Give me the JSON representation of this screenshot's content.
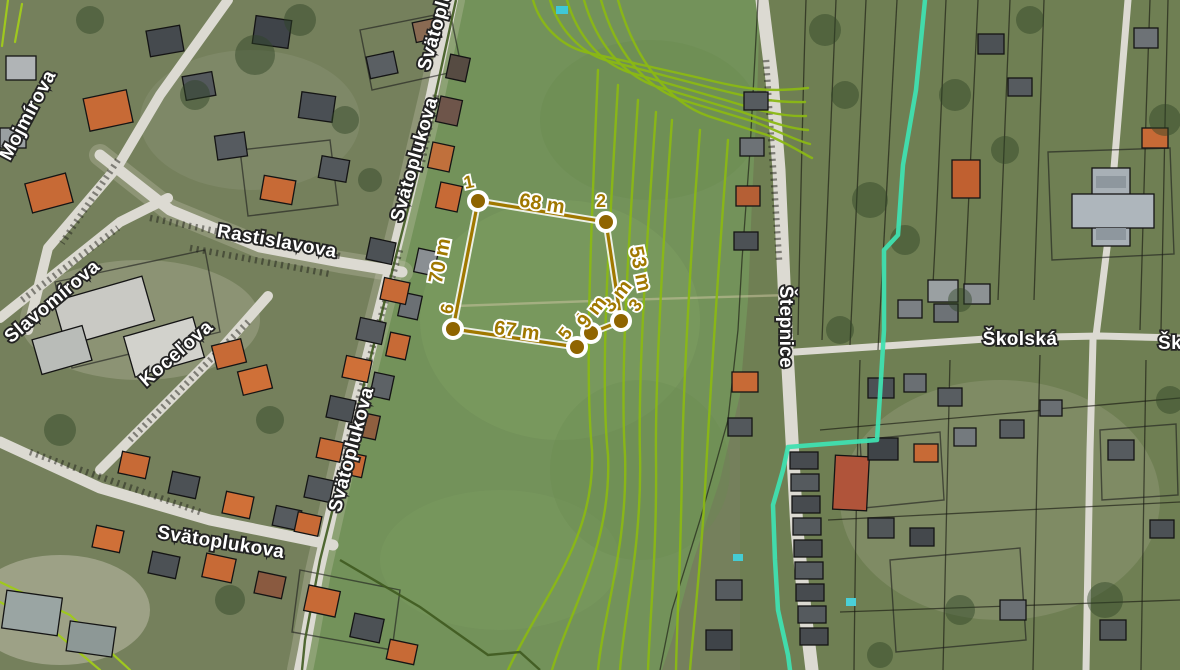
{
  "title": "Satellite cadastral map with measured parcel",
  "colors": {
    "measurement_gold": "#a07800",
    "measurement_halo": "#ffffff",
    "street_label_fill": "#ffffff",
    "street_label_outline": "#222222",
    "cadastral_green": "#8ab814",
    "utility_cyan": "#3fe0b0",
    "parcel_black": "#1b1b1b",
    "field_green": "#73925a",
    "road_grey": "#dcdad2",
    "roof_orange": "#c76a36",
    "roof_grey": "#53585c"
  },
  "labels": {
    "streets": [
      {
        "id": "mojmirova",
        "text": "Mojmírova"
      },
      {
        "id": "rastislavova",
        "text": "Rastislavova"
      },
      {
        "id": "slavomirova",
        "text": "Slavomírova"
      },
      {
        "id": "kocelova",
        "text": "Koceľova"
      },
      {
        "id": "svatoplukova-top",
        "text": "Svätoplukova"
      },
      {
        "id": "svatoplukova-main",
        "text": "Svätoplukova"
      },
      {
        "id": "svatoplukova-mid",
        "text": "Svätoplukova"
      },
      {
        "id": "svatoplukova-south",
        "text": "Svätoplukova"
      },
      {
        "id": "stepnice",
        "text": "Štepnice"
      },
      {
        "id": "skolska",
        "text": "Školská"
      },
      {
        "id": "skolska-edge",
        "text": "Školská"
      }
    ]
  },
  "measurement": {
    "vertices": [
      {
        "n": "1"
      },
      {
        "n": "2"
      },
      {
        "n": "3"
      },
      {
        "n": "4"
      },
      {
        "n": "5"
      },
      {
        "n": "6"
      }
    ],
    "segments": [
      {
        "label": "68 m"
      },
      {
        "label": "53 m"
      },
      {
        "label": "3 m"
      },
      {
        "label": "9 m"
      },
      {
        "label": "67 m"
      },
      {
        "label": "70 m"
      }
    ]
  }
}
